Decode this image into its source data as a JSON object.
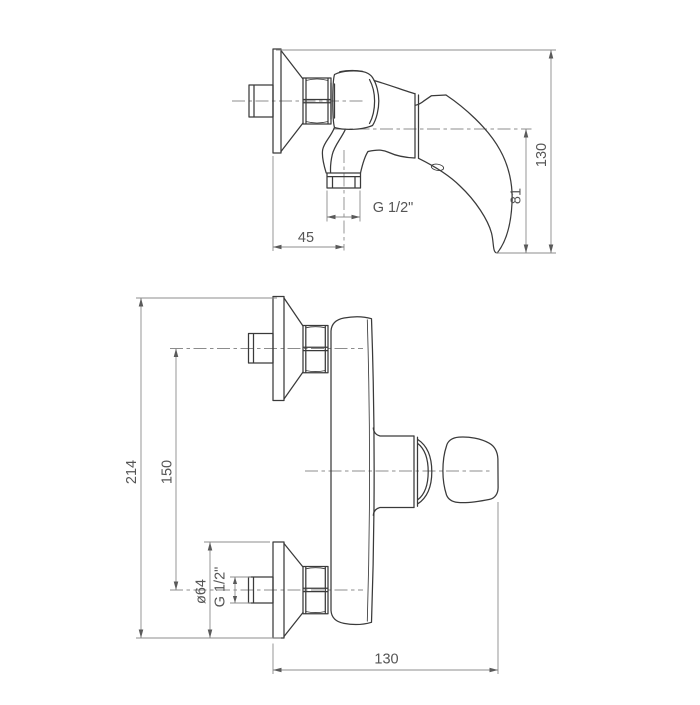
{
  "document": {
    "type": "technical-dimension-drawing",
    "subject": "wall-mounted single-lever shower mixer, side view and plan view"
  },
  "colors": {
    "outline": "#3a3a3a",
    "dim": "#8c8c8c",
    "arrow": "#5a5a5a",
    "text": "#555555",
    "background": "#ffffff"
  },
  "views": {
    "side_view": {
      "dims": {
        "height": "130",
        "outlet_height": "81",
        "wall_to_outlet_center": "45",
        "outlet_thread": "G 1/2\""
      }
    },
    "plan_view": {
      "dims": {
        "overall_height": "214",
        "inlet_spacing": "150",
        "escutcheon_diameter": "ø64",
        "inlet_thread": "G 1/2\"",
        "projection_length": "130"
      }
    }
  }
}
